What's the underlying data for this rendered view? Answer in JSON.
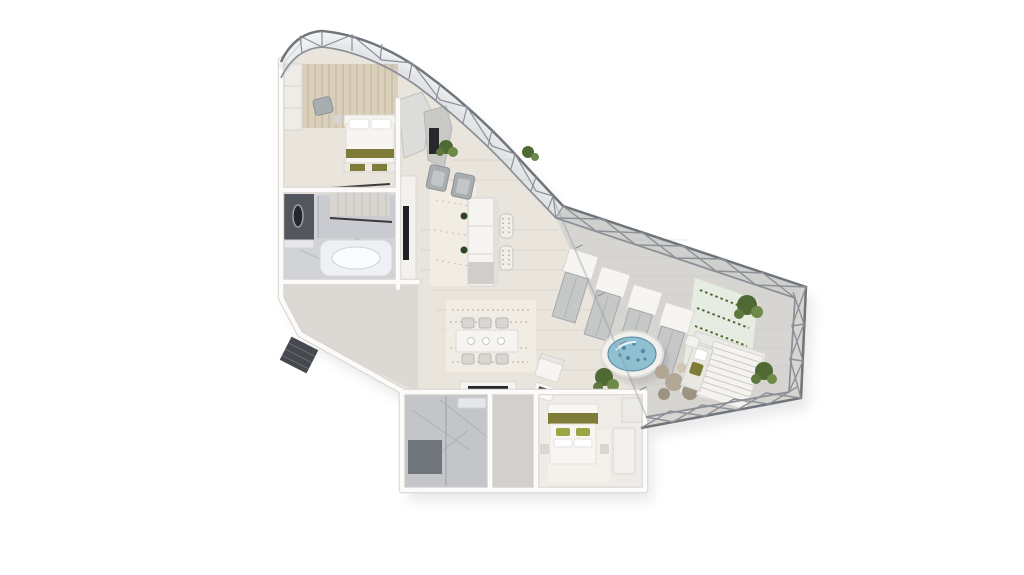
{
  "scene": {
    "kind": "3d-floorplan-rendering",
    "view": "top-down axonometric penthouse suite with curved glass facade and terrace",
    "background": "#ffffff"
  },
  "colors": {
    "background": "#ffffff",
    "steel": "#8b9197",
    "steel_dark": "#6f757b",
    "glass": "rgba(145,155,165,0.38)",
    "glass_fill": "rgba(170,180,190,0.16)",
    "interior_floor": "#e9e4dc",
    "terrace_deck": "#d7d5d1",
    "plank_line": "#c6c2bb",
    "wall": "#fcfbf9",
    "wall_shadow": "#d7d4cf",
    "hall_floor": "#dcd9d4",
    "corridor_floor": "#d2d0cc",
    "bath_floor": "#c4c5c9",
    "marble_light": "#d2d3d7",
    "marble_deck": "#eef0f3",
    "marble_dark": "#53565e",
    "wood_wall": "#d9cfba",
    "wood_stripe": "#c3b79d",
    "olive": "#7f7c3a",
    "green_pillow": "#9aa544",
    "plant": "#4f6a34",
    "plant_light": "#6d8a48",
    "water": "#8fc0d2",
    "water_deep": "#54889f",
    "rock": "#b2a794",
    "rock_dark": "#9d9383",
    "rug": "#f1ece4",
    "furn_gray": "#a8adb0",
    "furn_light": "#f5f4f1",
    "furn_stroke": "#d9d7d3",
    "tile_bg": "#e7ece3",
    "dark_slot": "#26282b",
    "tv_black": "#1f2124",
    "railing": "#3a3a3a",
    "shadow": "rgba(40,40,50,0.10)"
  },
  "inventory": {
    "bedrooms": 2,
    "bathrooms": 2,
    "sun_loungers": 4,
    "dining_chairs": 6,
    "dining_pendants": 3,
    "living_armchairs": 2,
    "hot_tub": 1,
    "cabana": 1,
    "fireplaces": 2,
    "plant_clusters": 5
  }
}
